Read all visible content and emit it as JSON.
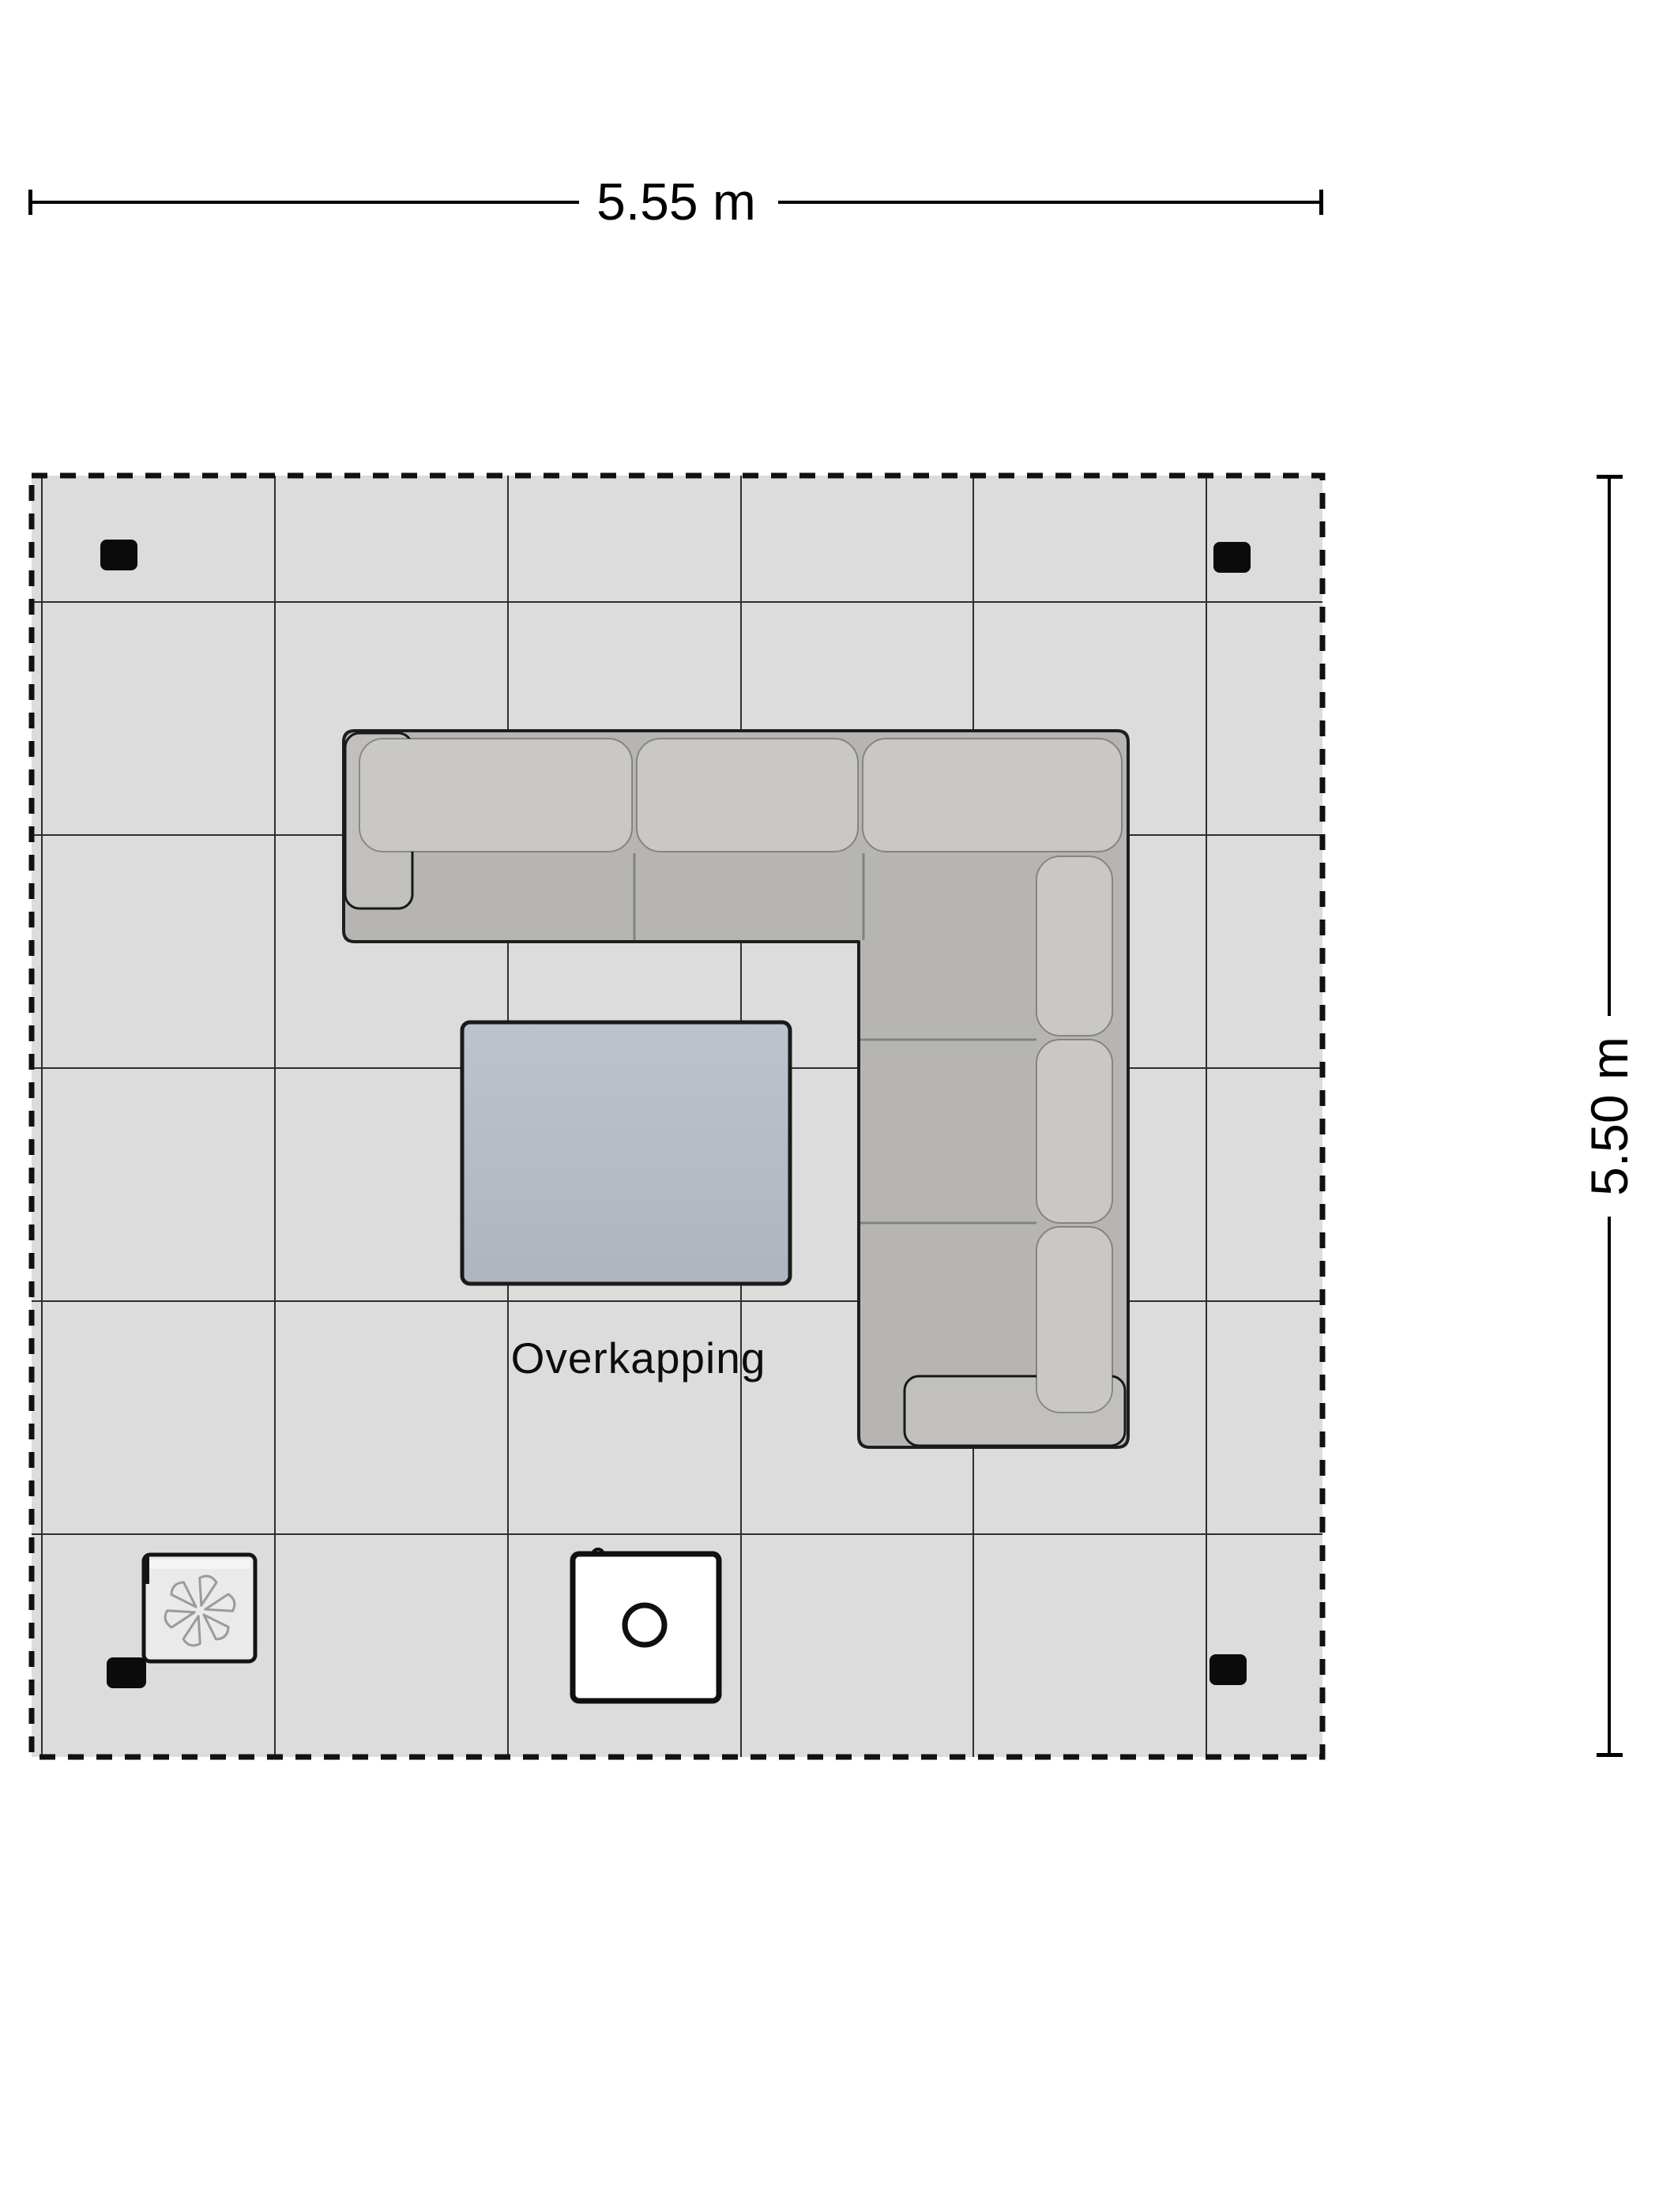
{
  "dimensions": {
    "width_label": "5.55 m",
    "height_label": "5.50 m"
  },
  "area": {
    "label": "Overkapping",
    "floor_color": "#dcdcdc",
    "grid_color": "#2e2e2e",
    "border_color": "#111111"
  },
  "objects": {
    "sofa": {
      "icon": "corner-sofa-icon",
      "base_color": "#b6b5b2",
      "cushion_color": "#c9c8c5",
      "armrest_color": "#c1c0bd",
      "outline_color": "#1e1e1e"
    },
    "table": {
      "icon": "coffee-table-icon",
      "top_color": "#bdc3cc",
      "bottom_color": "#afb5bf"
    },
    "heater": {
      "icon": "patio-heater-icon",
      "body_color": "#eaeaea",
      "fan_color": "#9b9b9b"
    },
    "fire_table": {
      "icon": "fire-pit-table-icon",
      "body_color": "#ffffff"
    },
    "posts": {
      "icon": "canopy-post-icon",
      "count": "4",
      "color": "#0b0b0b"
    }
  }
}
